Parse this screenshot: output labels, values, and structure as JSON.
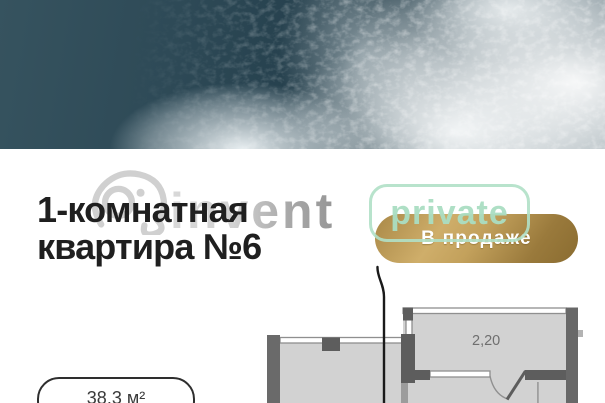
{
  "listing": {
    "title_line1": "1-комнатная",
    "title_line2": "квартира №6",
    "status_badge": "В продаже",
    "area_label": "38.3 м²"
  },
  "floor_plan": {
    "dimension_label": "2,20"
  },
  "watermark": {
    "brand": "invent",
    "private_label": "private"
  },
  "colors": {
    "badge_gold_light": "#cfae6a",
    "badge_gold_dark": "#8a6c30",
    "watermark_mint": "#aaddc2",
    "watermark_gray": "#c9c9c9",
    "title_color": "#1f1f1f",
    "plan_wall_dark": "#5d5d5d",
    "plan_wall_mid": "#6a6a6a",
    "plan_interior": "#d2d2d2",
    "photo_water": "#27424f"
  }
}
